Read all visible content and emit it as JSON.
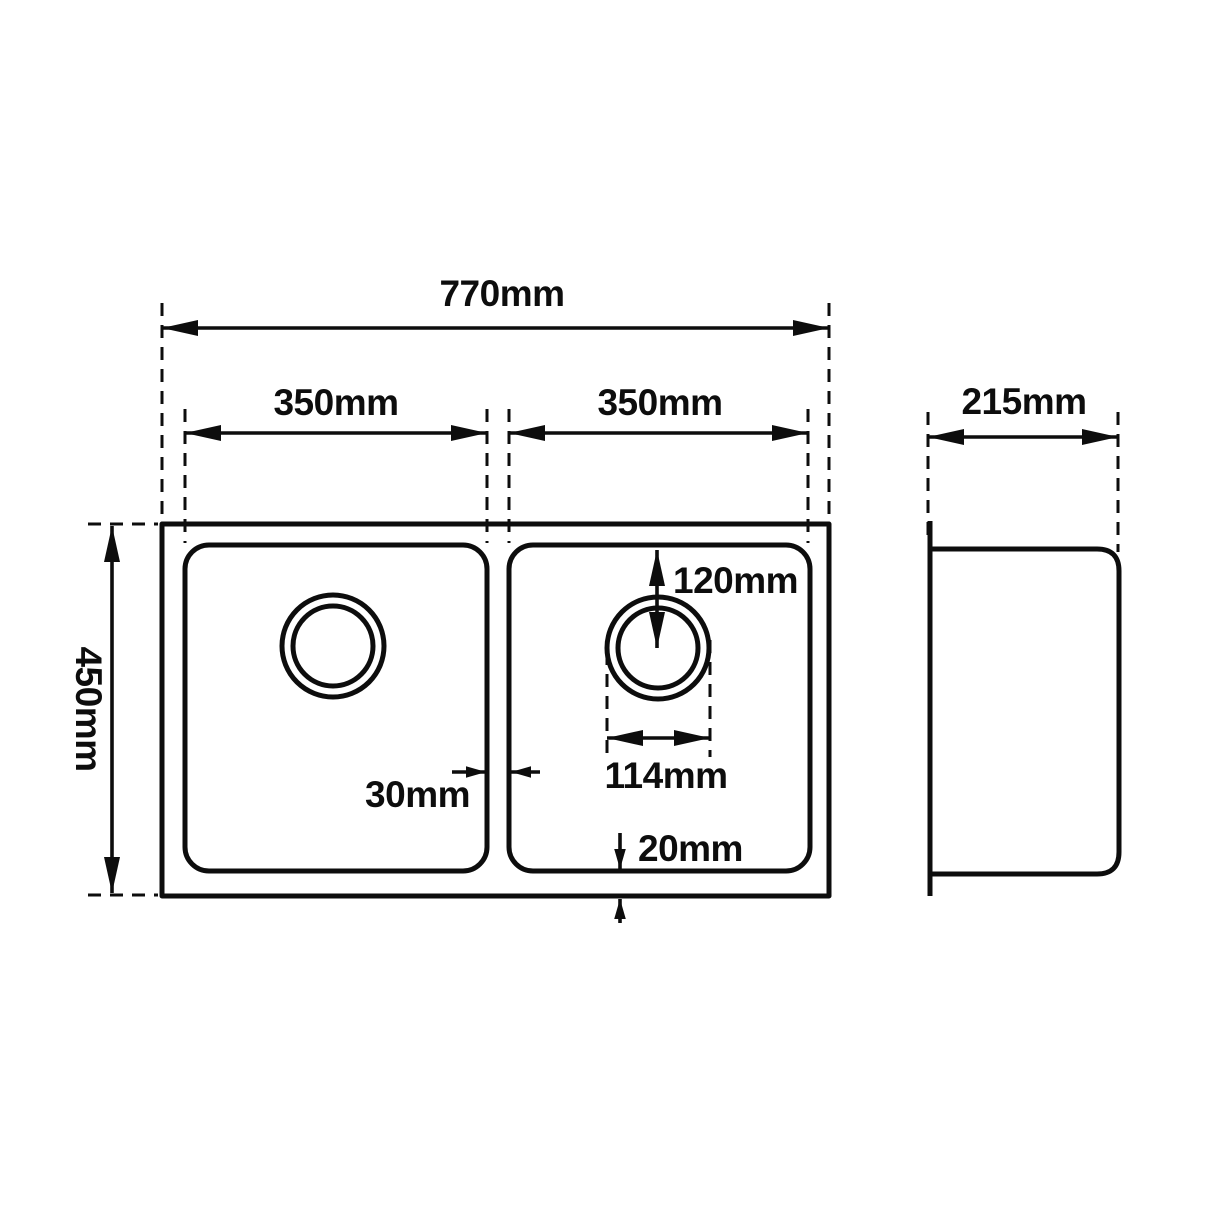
{
  "title": "Double bowl sink technical dimension drawing",
  "colors": {
    "line": "#0d0d0d",
    "background": "#ffffff"
  },
  "drawing": {
    "plan_view": {
      "overall_width": "770mm",
      "left_bowl_width": "350mm",
      "right_bowl_width": "350mm",
      "overall_depth": "450mm",
      "divider_width": "30mm",
      "drain_center_from_top": "120mm",
      "drain_diameter": "114mm",
      "bowl_to_edge_gap": "20mm"
    },
    "side_view": {
      "depth": "215mm"
    }
  }
}
